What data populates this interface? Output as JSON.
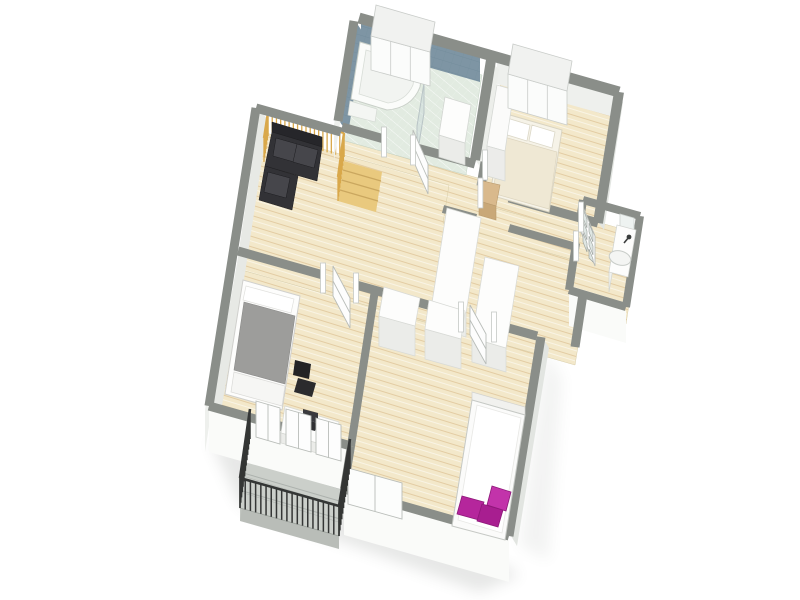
{
  "meta": {
    "title": "3D rendered apartment floor plan",
    "view": "isometric bird's-eye architectural visualization",
    "background": "#ffffff"
  },
  "palette": {
    "bg": "#ffffff",
    "wall_top": "#8a8e89",
    "wall_face_light": "#eef0ed",
    "wall_face_bright": "#fafbf9",
    "wall_inner": "#e7e9e5",
    "wall_inner_dim": "#e2e5e1",
    "partition_face": "#eceeea",
    "tile_wall": "#7e95a4",
    "tile_joint": "#6d8796",
    "bath_floor": "#e2ebe1",
    "bath_joint": "#ffffff",
    "wood_base": "#f3e8ca",
    "wood_line": "#c9a368",
    "balcony_floor": "#cbcfca",
    "balcony_seam": "#a9aeaa",
    "balcony_edge": "#b9bdb8",
    "railing_dark": "#343635",
    "railing_gold": "#d9a84b",
    "stair_wood": "#e9c97e",
    "stair_line": "#caa75f",
    "sofa_dark": "#323236",
    "sofa_back": "#26262a",
    "sofa_cushion": "#46464b",
    "bed1_frame": "#f6f3e8",
    "bed1_duvet": "#efe8d4",
    "bed2_duvet": "#9d9d9b",
    "bed3_white": "#ffffff",
    "magenta": "#b5269c",
    "magenta_dark": "#8e1879",
    "furniture_white": "#fdfdfc",
    "furniture_front": "#ebece9",
    "furniture_side": "#f1f2ef",
    "door_white": "#fdfdfd",
    "door_edge": "#b9bdb9",
    "glass": "#dfe6e3",
    "wood_accent": "#d9b98c",
    "wood_accent_dark": "#c9a878",
    "chair_dark": "#2b2b2d",
    "laptop_dark": "#303033",
    "shadow": "#6a6f6a"
  },
  "scene": {
    "title": "Apartment level with six zones and balcony",
    "rooms": [
      {
        "key": "bathroom",
        "name": "Bathroom with corner bathtub"
      },
      {
        "key": "bedroom-top",
        "name": "Bedroom with double bed"
      },
      {
        "key": "hallway",
        "name": "Hallway"
      },
      {
        "key": "wc",
        "name": "WC with washbasin"
      },
      {
        "key": "living",
        "name": "Living room with sofa and stairs"
      },
      {
        "key": "bedroom-left",
        "name": "Bedroom with desk"
      },
      {
        "key": "bedroom-right",
        "name": "Bedroom with magenta pillows"
      },
      {
        "key": "balcony",
        "name": "Balcony with metal railing"
      }
    ],
    "furniture": [
      "corner bathtub",
      "washbasin cabinet",
      "sliding-door closets",
      "double bed",
      "bedside unit",
      "black corner sofa",
      "stair railing",
      "kitchen islands",
      "wardrobes",
      "gray bed",
      "desk with laptop",
      "office chair",
      "single bed",
      "magenta pillows",
      "wc vanity with sink",
      "balcony railing",
      "sliding glass doors"
    ]
  }
}
